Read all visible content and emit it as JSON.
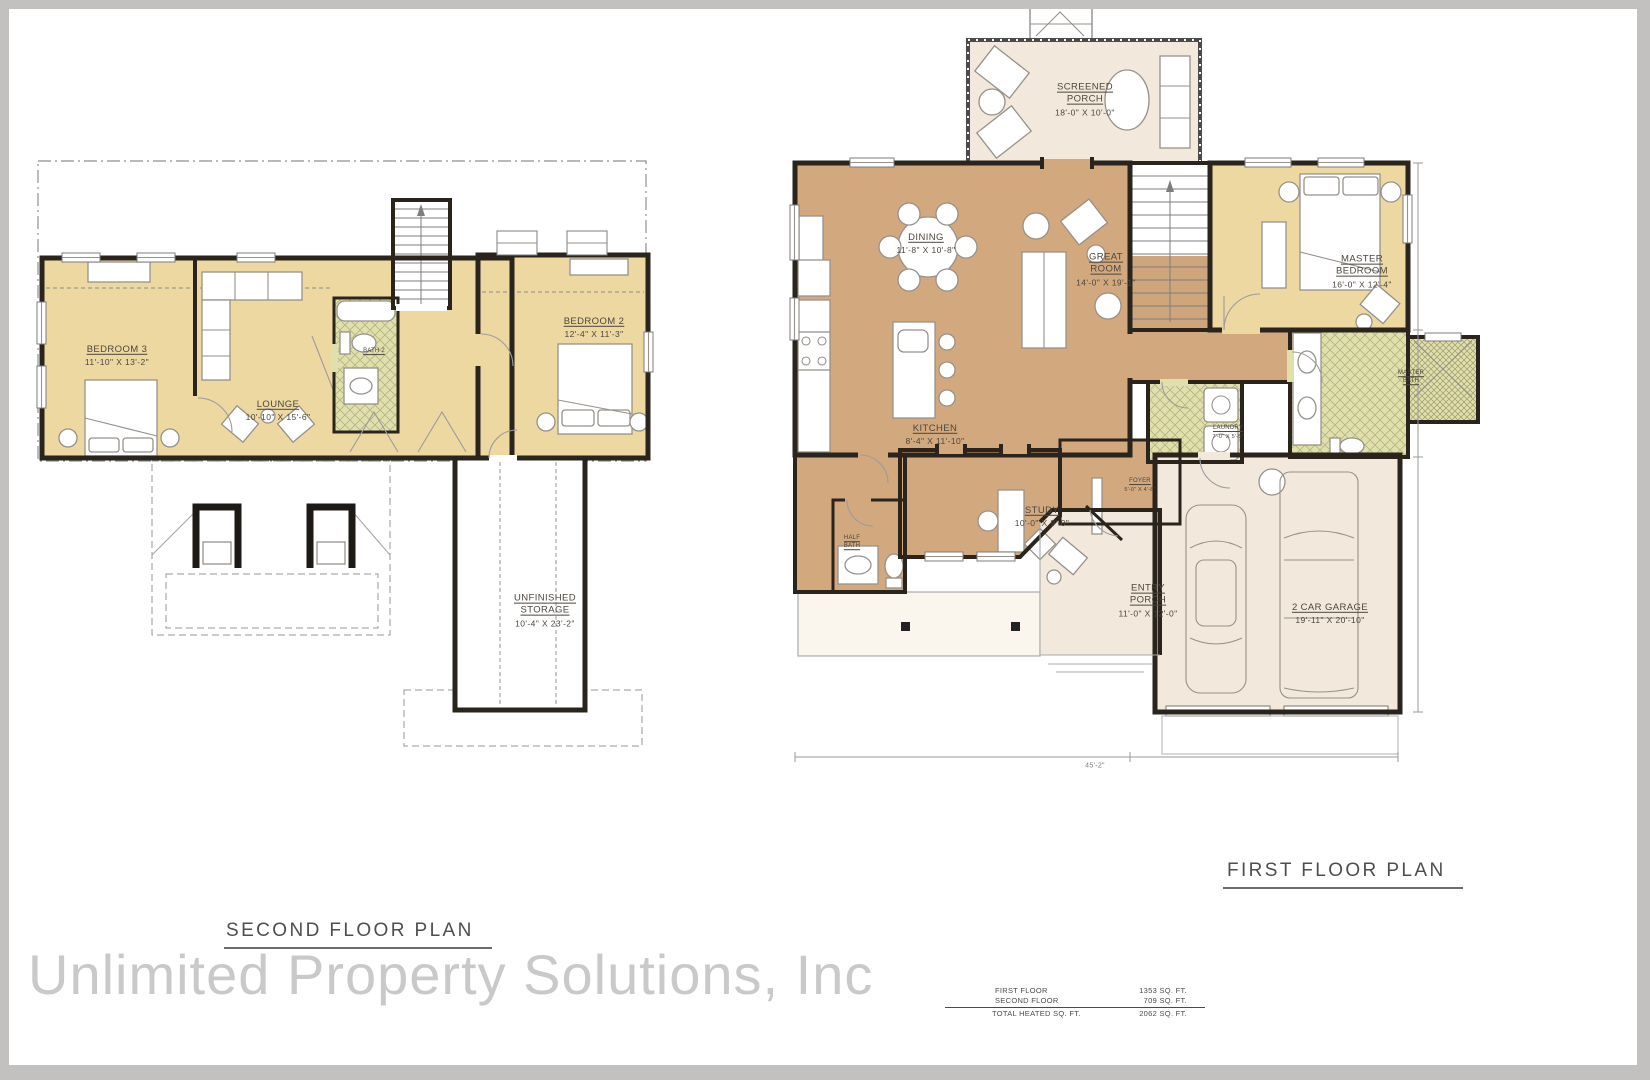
{
  "watermark": {
    "text": "Unlimited Property Solutions, Inc"
  },
  "palette": {
    "wall": "#2a241d",
    "bedroom_tan": "#ecd8a0",
    "living_brown": "#d2a87e",
    "porch_beige": "#f2e9dc",
    "bath_green": "#e0e0ac",
    "frame_gray": "#c3c1bf",
    "watermark_gray": "#c9c9c9"
  },
  "second_floor": {
    "title": "SECOND FLOOR PLAN",
    "rooms": [
      {
        "name": "BEDROOM 3",
        "dims": "11'-10\" X 13'-2\""
      },
      {
        "name": "LOUNGE",
        "dims": "10'-10\" X 15'-6\""
      },
      {
        "name": "BATH 2",
        "dims": ""
      },
      {
        "name": "BEDROOM 2",
        "dims": "12'-4\" X 11'-3\""
      },
      {
        "name": "UNFINISHED STORAGE",
        "dims": "10'-4\" X 23'-2\""
      }
    ]
  },
  "first_floor": {
    "title": "FIRST FLOOR PLAN",
    "dimension_bottom": "45'-2\"",
    "rooms": [
      {
        "name": "SCREENED PORCH",
        "dims": "18'-0\" X 10'-0\""
      },
      {
        "name": "DINING",
        "dims": "11'-8\" X 10'-8\""
      },
      {
        "name": "GREAT ROOM",
        "dims": "14'-0\" X 19'-1\""
      },
      {
        "name": "MASTER BEDROOM",
        "dims": "16'-0\" X 12'-4\""
      },
      {
        "name": "KITCHEN",
        "dims": "8'-4\" X 11'-10\""
      },
      {
        "name": "STUDY",
        "dims": "10'-0\" X 9'-0\""
      },
      {
        "name": "FOYER",
        "dims": "5'-0\" X 4'-8\""
      },
      {
        "name": "LAUNDRY",
        "dims": "7'-0\" X 5'-5\""
      },
      {
        "name": "MASTER BATH",
        "dims": ""
      },
      {
        "name": "HALF BATH",
        "dims": ""
      },
      {
        "name": "ENTRY PORCH",
        "dims": "11'-0\" X 12'-0\""
      },
      {
        "name": "2 CAR GARAGE",
        "dims": "19'-11\" X 20'-10\""
      }
    ]
  },
  "area_table": {
    "rows": [
      {
        "label": "FIRST FLOOR",
        "value": "1353 SQ. FT."
      },
      {
        "label": "SECOND FLOOR",
        "value": "709 SQ. FT."
      }
    ],
    "total": {
      "label": "TOTAL HEATED SQ. FT.",
      "value": "2062 SQ. FT."
    }
  }
}
